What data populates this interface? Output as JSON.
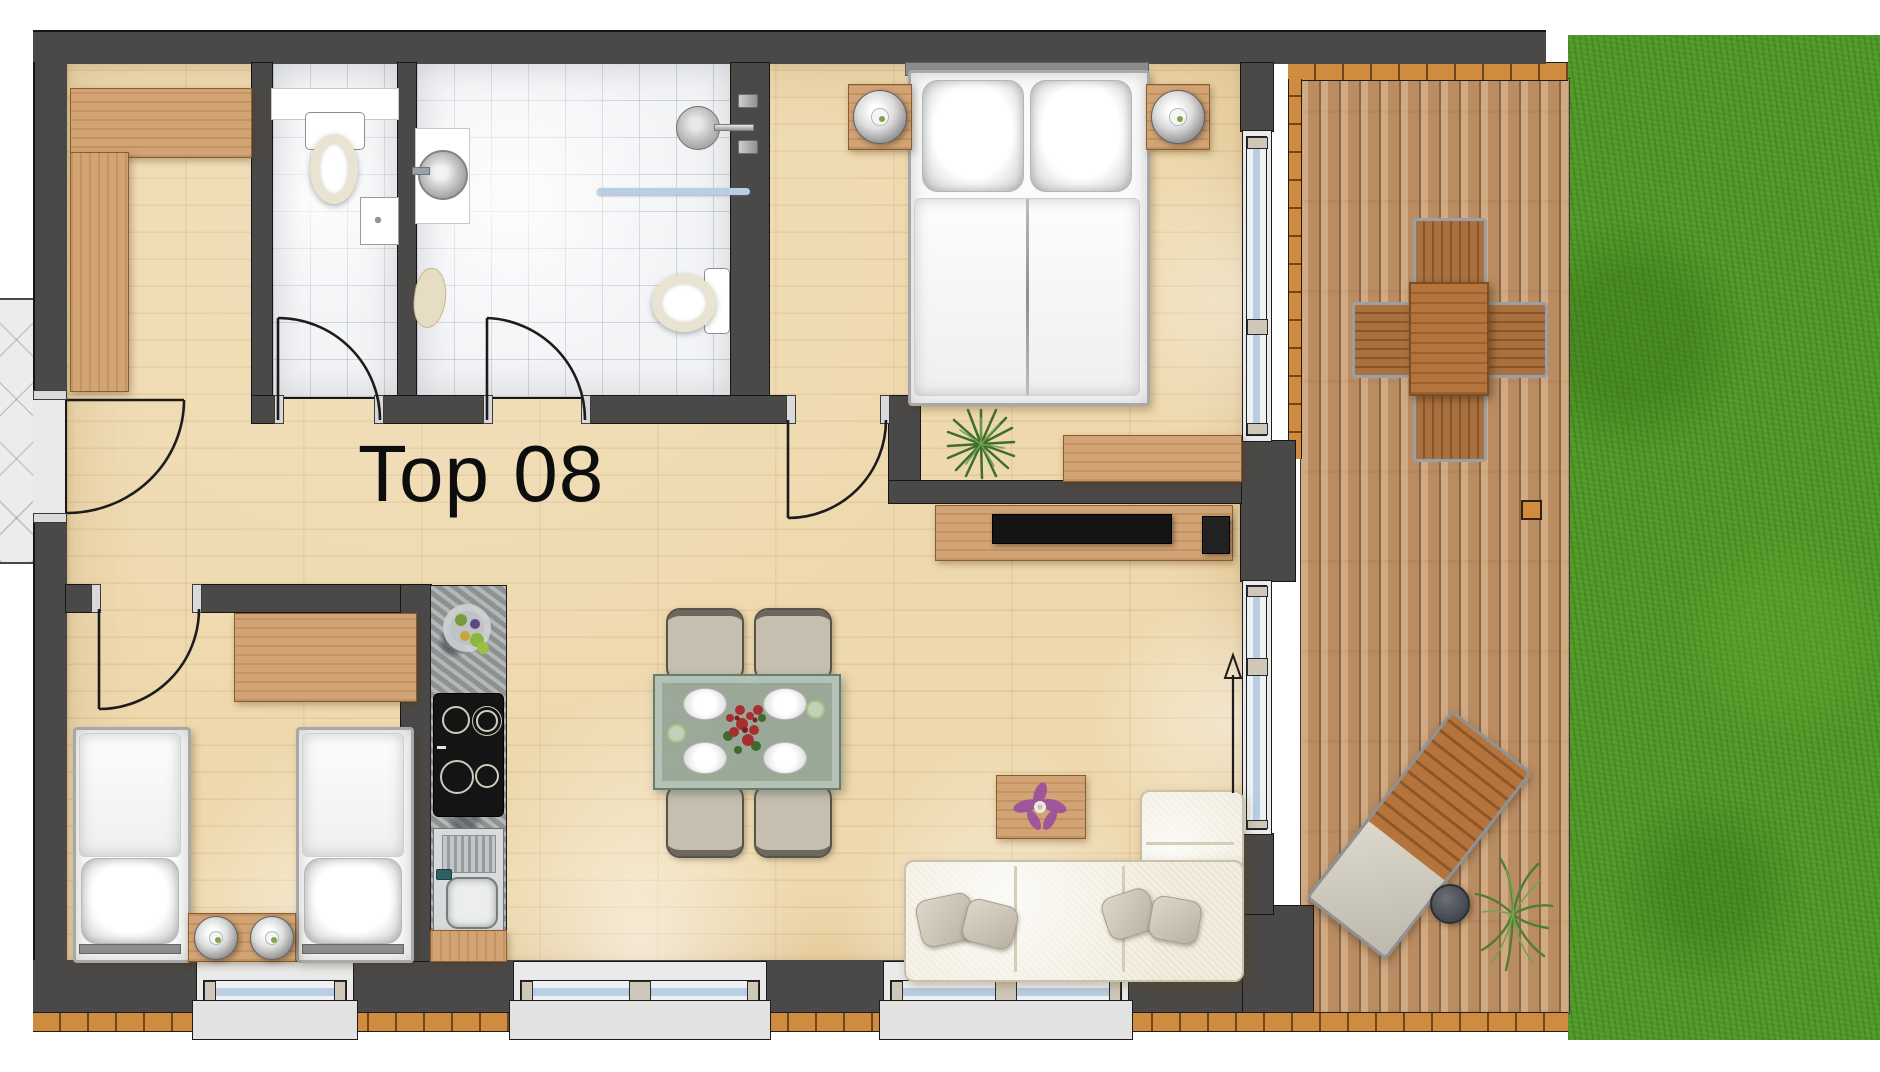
{
  "plan": {
    "unit_label": "Top 08",
    "type_note": "apartment floor plan, top-down view"
  },
  "icons": {
    "direction_arrow": "sliding-door entry direction arrow pointing up"
  },
  "colors": {
    "wall": "#4b4947",
    "outline": "#171717",
    "floor_wood": "#eed8ac",
    "tile": "#f3f4f6",
    "deck": "#c2946a",
    "deck_gap": "#8a6647",
    "trim": "#d08c3e",
    "grass": "#4f9728",
    "glass": "#b9cde3",
    "frame": "#eaeaea",
    "sill": "#e2e2e2",
    "cap": "#cfc7b8",
    "furn_wood": "#d2a374",
    "granite": "#a3a7a8",
    "sofa": "#f2edde",
    "chair": "#c6bfb0",
    "table_edge": "#657e6d",
    "bed_frame": "#a8a8a8",
    "tv": "#141414",
    "plant": "#4e7d35",
    "flower_red": "#a72f2f",
    "flower_purple": "#9a4f9e"
  }
}
